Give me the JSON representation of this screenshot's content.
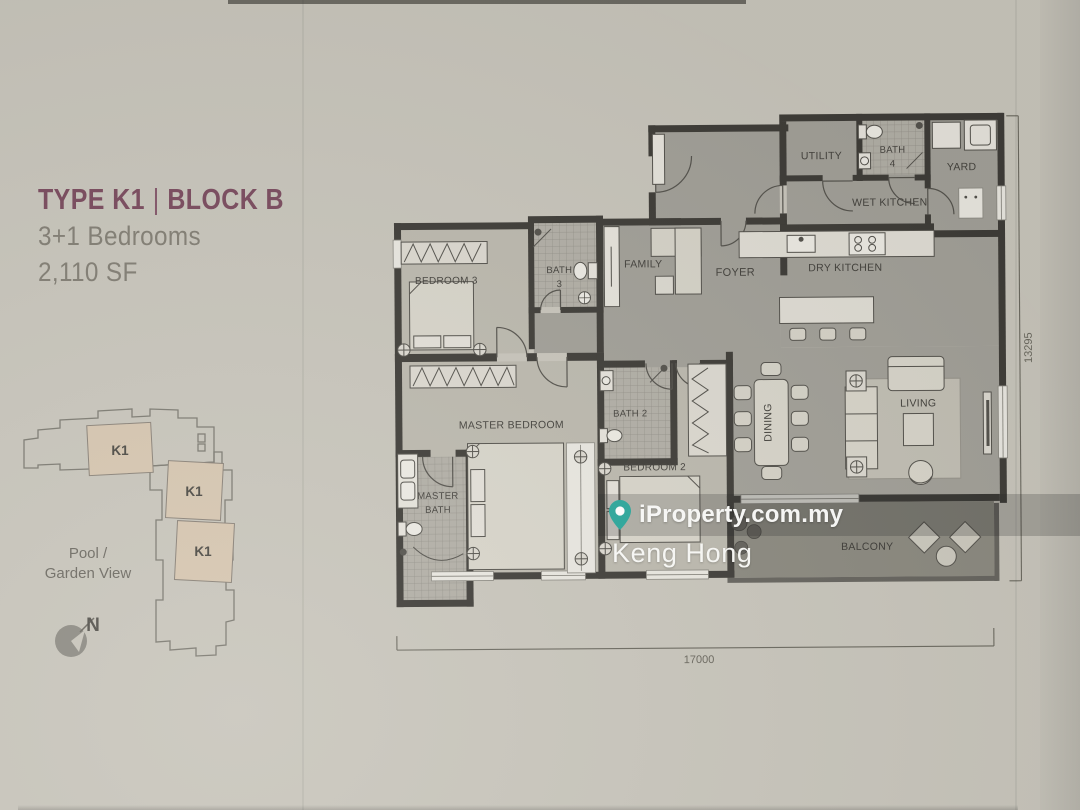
{
  "panel": {
    "title": {
      "type": "TYPE K1",
      "separator": "|",
      "block": "BLOCK B"
    },
    "bedrooms": "3+1 Bedrooms",
    "area": "2,110 SF",
    "site_plan": {
      "units": [
        "K1",
        "K1",
        "K1"
      ],
      "view_line1": "Pool /",
      "view_line2": "Garden View",
      "north": "N"
    }
  },
  "floorplan": {
    "rooms": {
      "foyer": "FOYER",
      "utility": "UTILITY",
      "bath4_l1": "BATH",
      "bath4_l2": "4",
      "yard": "YARD",
      "wet_kitchen": "WET KITCHEN",
      "dry_kitchen": "DRY KITCHEN",
      "family": "FAMILY",
      "bedroom3": "BEDROOM 3",
      "bath3_l1": "BATH",
      "bath3_l2": "3",
      "master_bedroom": "MASTER BEDROOM",
      "master_bath_l1": "MASTER",
      "master_bath_l2": "BATH",
      "bath2": "BATH 2",
      "bedroom2": "BEDROOM 2",
      "dining": "DINING",
      "living": "LIVING",
      "balcony": "BALCONY"
    },
    "dimensions": {
      "width": "17000",
      "height": "13295"
    }
  },
  "watermark": {
    "brand": "iProperty.com.my",
    "agent": "Keng Hong",
    "pin_color": "#2aa79b"
  },
  "colors": {
    "title": "#7a4b5e",
    "paper": "#c8c5bb",
    "walls": "#3f3d38",
    "floor_common": "#a2a098",
    "floor_bedroom": "#bcb9ae",
    "floor_balcony": "#8b897f",
    "unit_highlight": "#d6c6b0"
  }
}
